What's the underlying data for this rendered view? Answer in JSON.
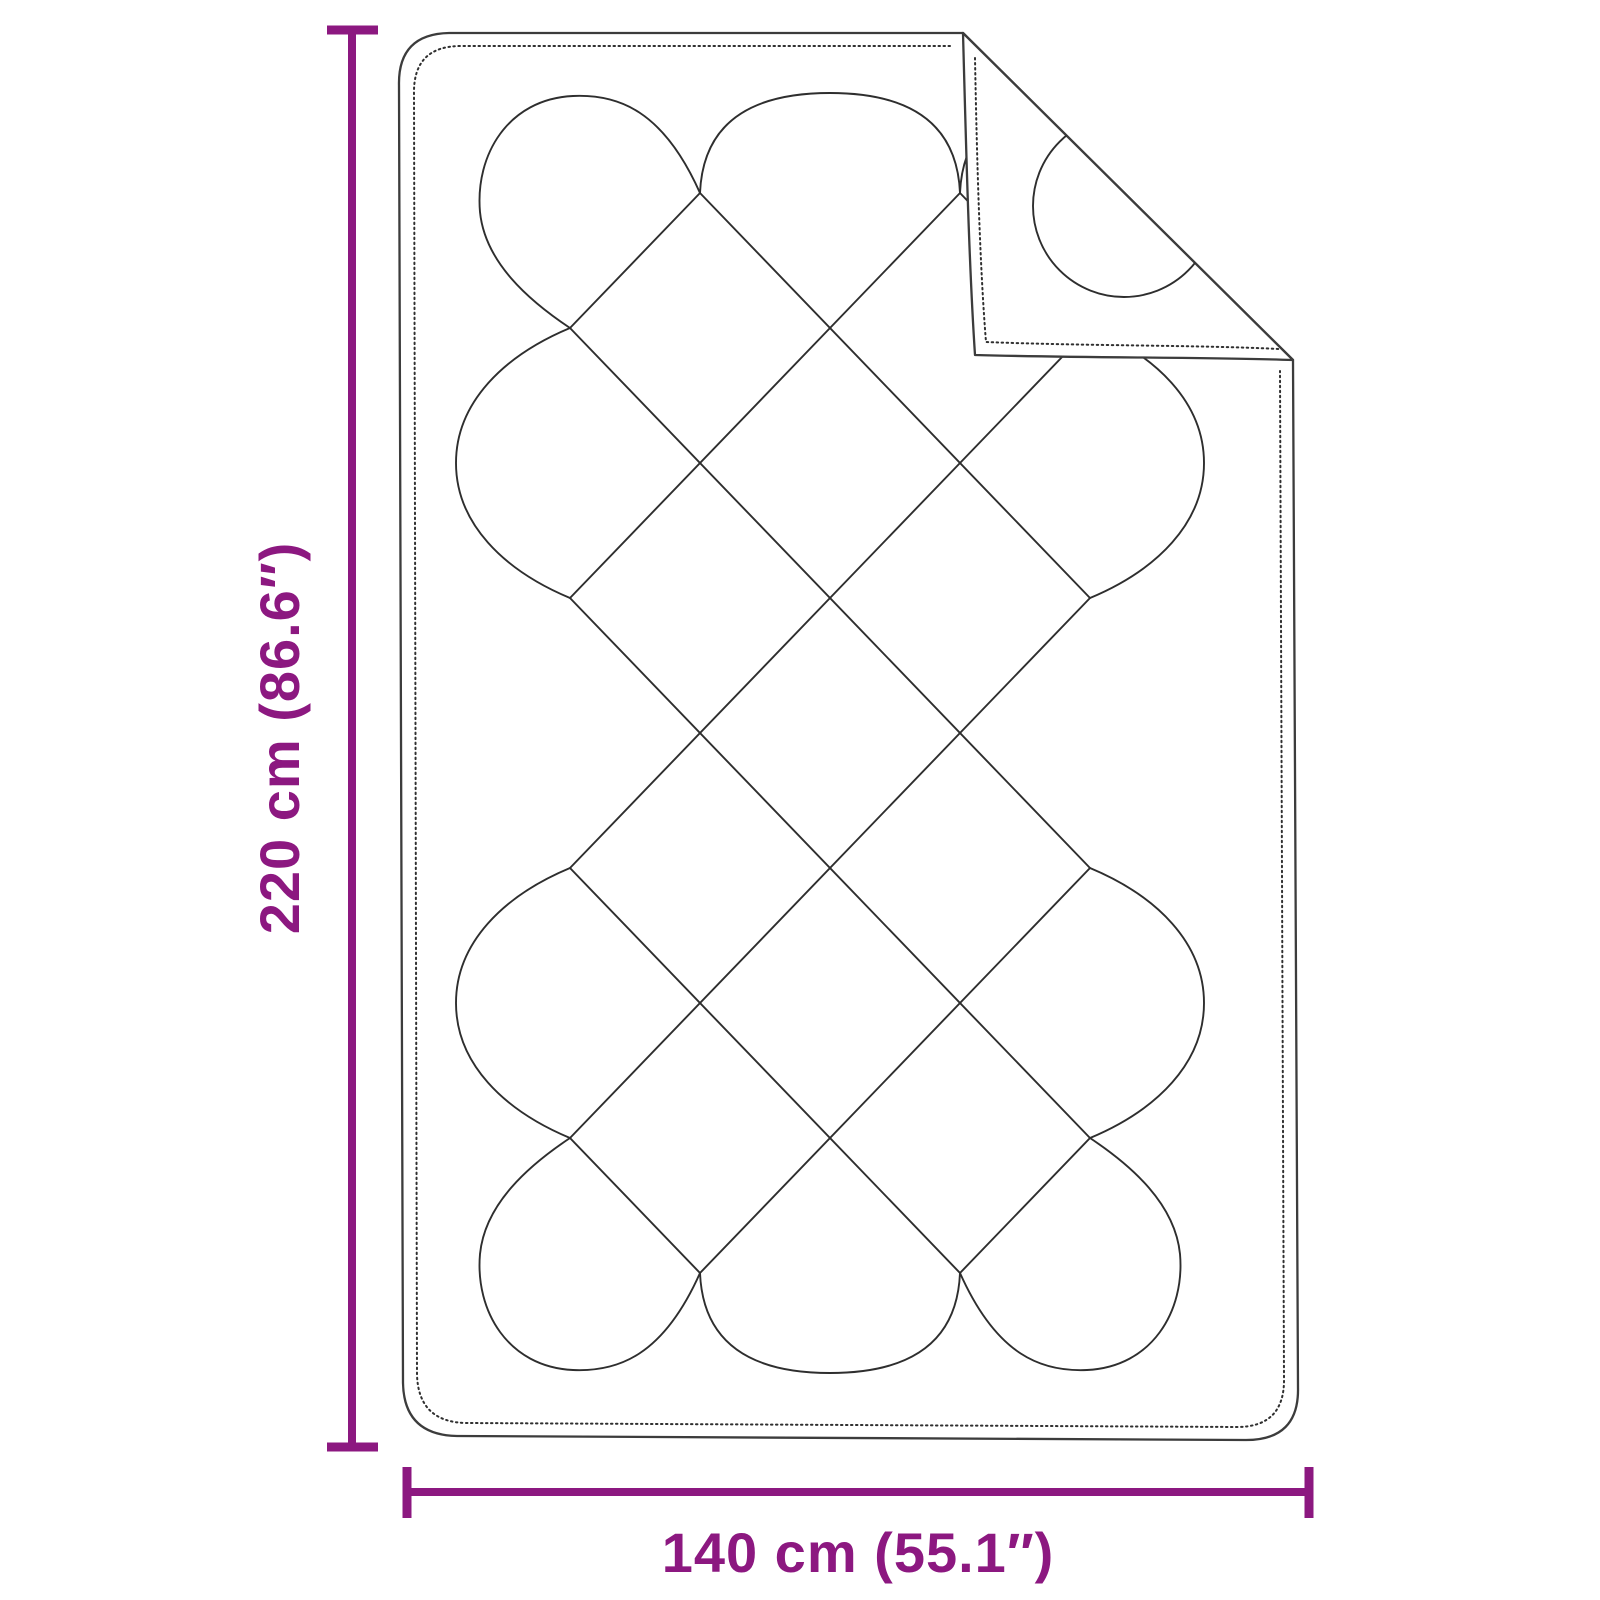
{
  "illustration": {
    "label": "Quilted blanket with folded top-right corner",
    "outline_color": "#3c3c3c",
    "stitch_color": "#2e2e2e"
  },
  "dimensions": {
    "accent_color": "#8C1880",
    "height_label": "220 cm (86.6″)",
    "width_label": "140 cm (55.1″)"
  }
}
